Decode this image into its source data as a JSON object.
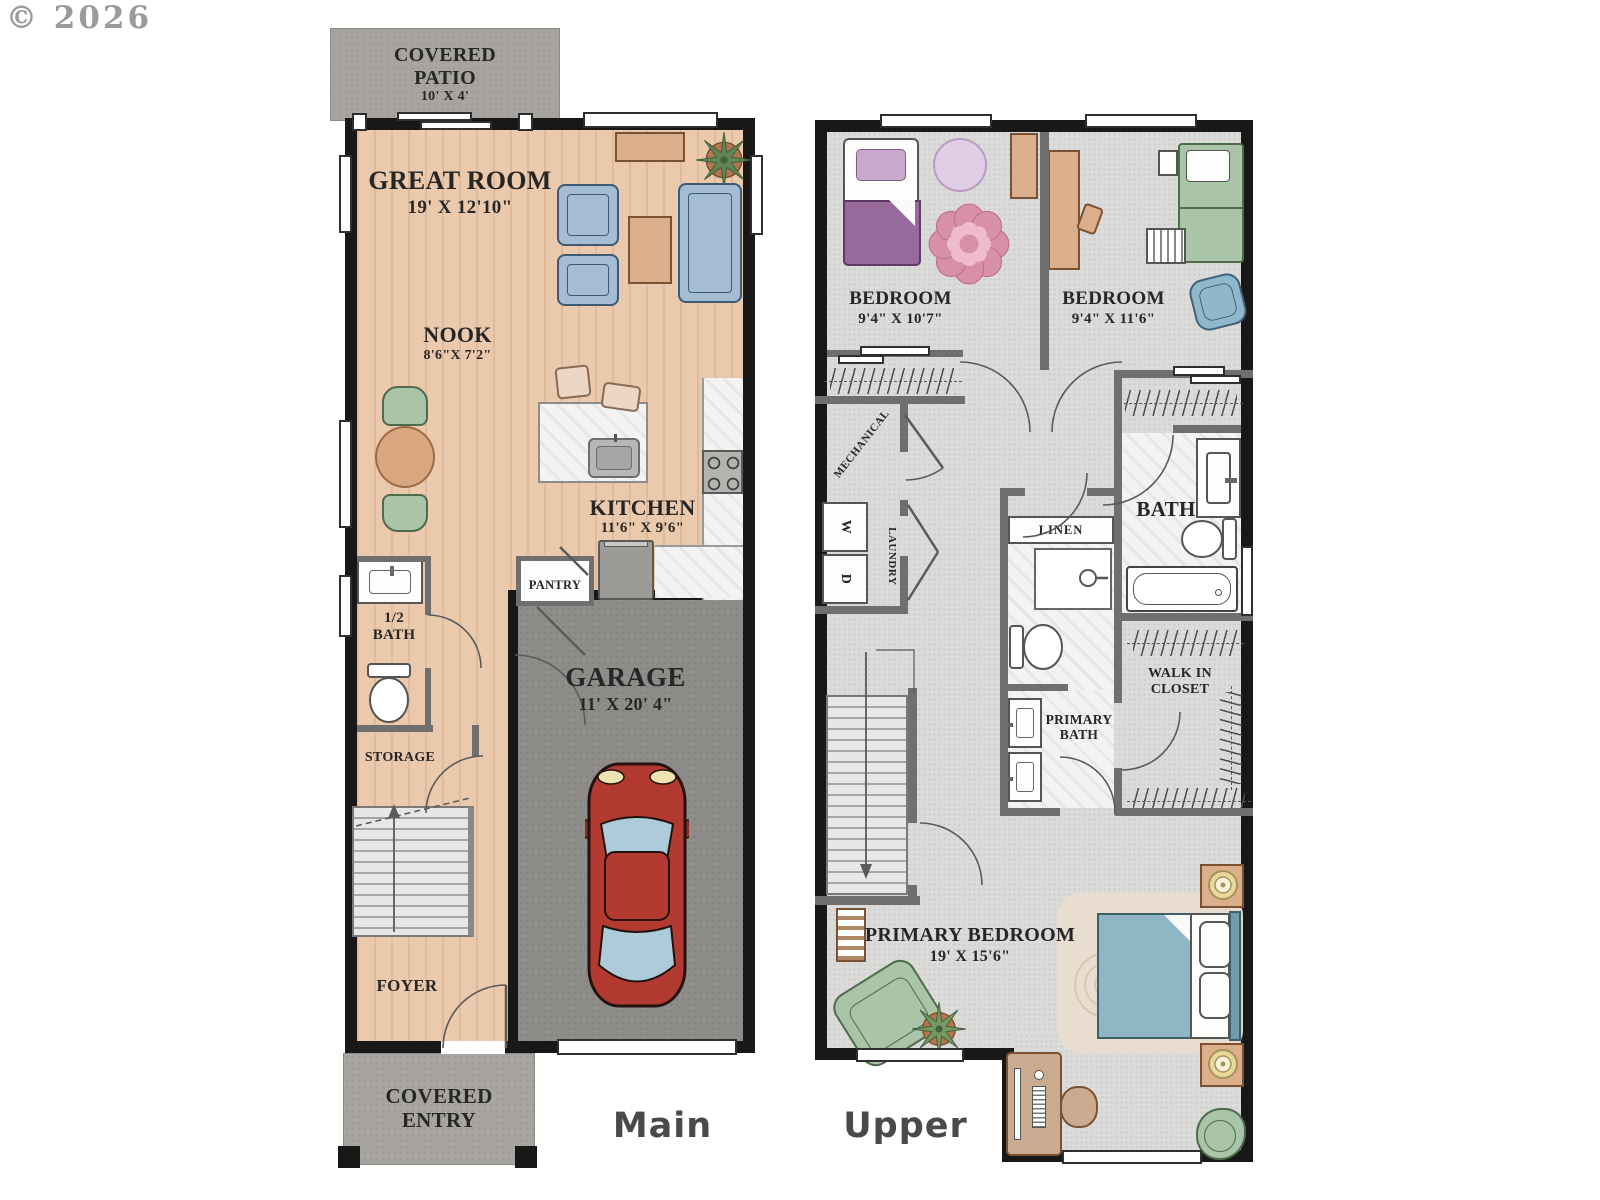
{
  "watermark": "© 2026",
  "colors": {
    "wood_floor": "#ebc9ac",
    "carpet": "#dbdbd9",
    "garage_concrete": "#8e8c89",
    "patio_concrete": "#a8a5a1",
    "exterior_wall": "#181818",
    "interior_wall": "#6f6f6f",
    "sofa_blue": "#a4bdd2",
    "chair_green": "#a9c4a6",
    "table_tan": "#dcaf8c",
    "bed_purple": "#97699c",
    "rug_pink": "#d890aa",
    "bed_teal": "#8fb6c4",
    "car_red": "#b23a30"
  },
  "main_floor": {
    "floor_label": "Main",
    "covered_patio": {
      "name": "COVERED PATIO",
      "dims": "10' X 4'"
    },
    "great_room": {
      "name": "GREAT ROOM",
      "dims": "19' X 12'10\""
    },
    "nook": {
      "name": "NOOK",
      "dims": "8'6\"X 7'2\""
    },
    "kitchen": {
      "name": "KITCHEN",
      "dims": "11'6\" X 9'6\""
    },
    "pantry": {
      "name": "PANTRY"
    },
    "half_bath": {
      "name": "1/2 BATH"
    },
    "storage": {
      "name": "STORAGE"
    },
    "foyer": {
      "name": "FOYER"
    },
    "garage": {
      "name": "GARAGE",
      "dims": "11' X 20' 4\""
    },
    "covered_entry": {
      "name": "COVERED ENTRY"
    }
  },
  "upper_floor": {
    "floor_label": "Upper",
    "bedroom_left": {
      "name": "BEDROOM",
      "dims": "9'4\" X 10'7\""
    },
    "bedroom_right": {
      "name": "BEDROOM",
      "dims": "9'4\" X 11'6\""
    },
    "mechanical": {
      "name": "MECHANICAL"
    },
    "laundry": {
      "name": "LAUNDRY",
      "washer": "W",
      "dryer": "D"
    },
    "linen": {
      "name": "LINEN"
    },
    "bath": {
      "name": "BATH"
    },
    "primary_bath": {
      "name": "PRIMARY BATH"
    },
    "walk_in_closet": {
      "name": "WALK IN CLOSET"
    },
    "primary_bedroom": {
      "name": "PRIMARY BEDROOM",
      "dims": "19' X 15'6\""
    }
  }
}
